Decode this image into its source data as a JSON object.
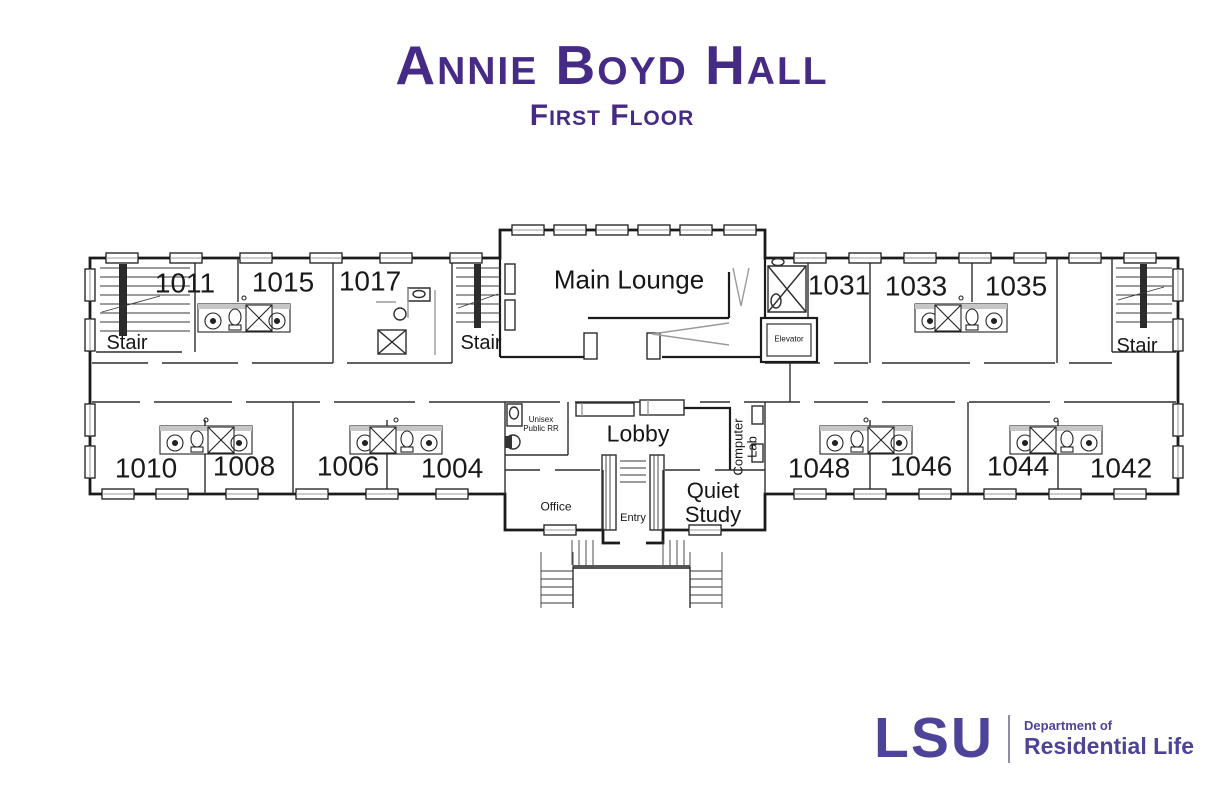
{
  "header": {
    "title": "Annie Boyd Hall",
    "subtitle": "First Floor"
  },
  "plan": {
    "rooms_top": [
      "1011",
      "1015",
      "1017",
      "1031",
      "1033",
      "1035"
    ],
    "rooms_bottom": [
      "1010",
      "1008",
      "1006",
      "1004",
      "1048",
      "1046",
      "1044",
      "1042"
    ],
    "labels": {
      "stair": "Stair",
      "main_lounge": "Main Lounge",
      "elevator": "Elevator",
      "lobby": "Lobby",
      "computer_lab": "Computer Lab",
      "office": "Office",
      "entry": "Entry",
      "quiet_study": "Quiet Study",
      "unisex_rr": "Unisex Public RR"
    }
  },
  "footer": {
    "logo": "LSU",
    "dept_prefix": "Department of",
    "dept_name": "Residential Life"
  },
  "colors": {
    "title_purple": "#452B85",
    "logo_purple": "#4D4499",
    "wall_black": "#1B1B1B"
  }
}
